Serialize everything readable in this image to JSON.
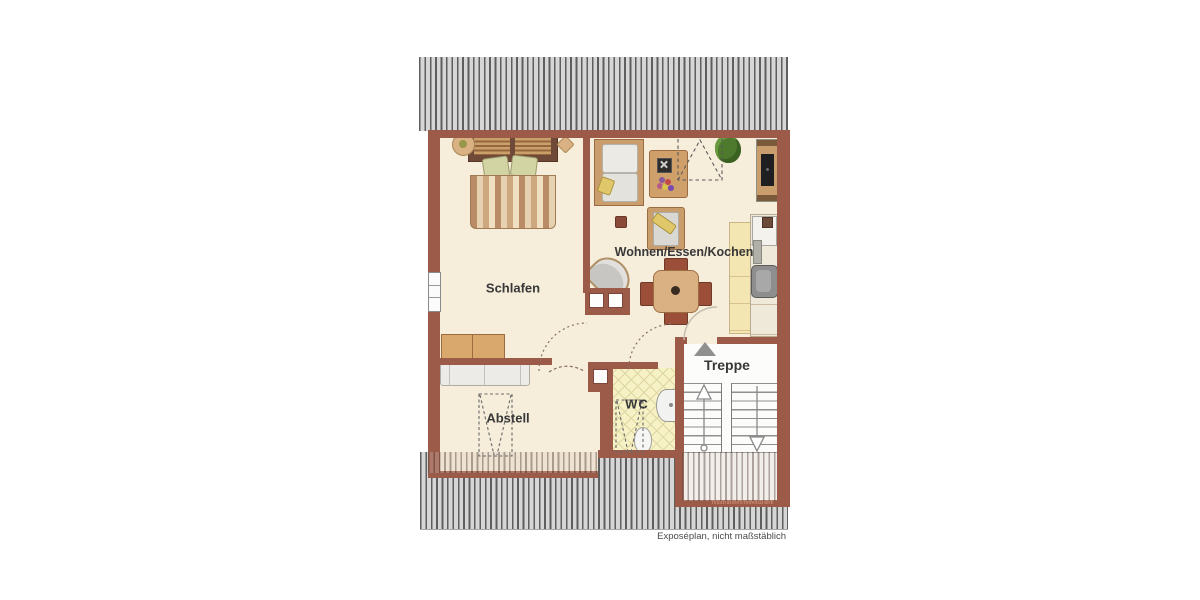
{
  "plan": {
    "rooms": {
      "schlafen": {
        "label": "Schlafen"
      },
      "wohnen": {
        "label": "Wohnen/Essen/Kochen"
      },
      "wc": {
        "label": "WC"
      },
      "treppe": {
        "label": "Treppe"
      },
      "abstell": {
        "label": "Abstell"
      }
    },
    "footer_note": "Exposéplan, nicht maßstäblich",
    "watermark": "Illustration©ImmoGrafik",
    "colors": {
      "wall": "#9c5a49",
      "floor": "#f6edda",
      "wc_floor": "#f7f2c6",
      "stair_room": "#fcfcfb",
      "roof_hatch_bg": "#d6d6d6",
      "roof_hatch_stripe": "#5e5e5e",
      "wood_furniture": "#c99e6c",
      "kitchen_cabinet": "#f4e6b2",
      "dining_chair": "#9b4f38",
      "plant": "#4e7a2e",
      "label_text": "#383838"
    }
  }
}
